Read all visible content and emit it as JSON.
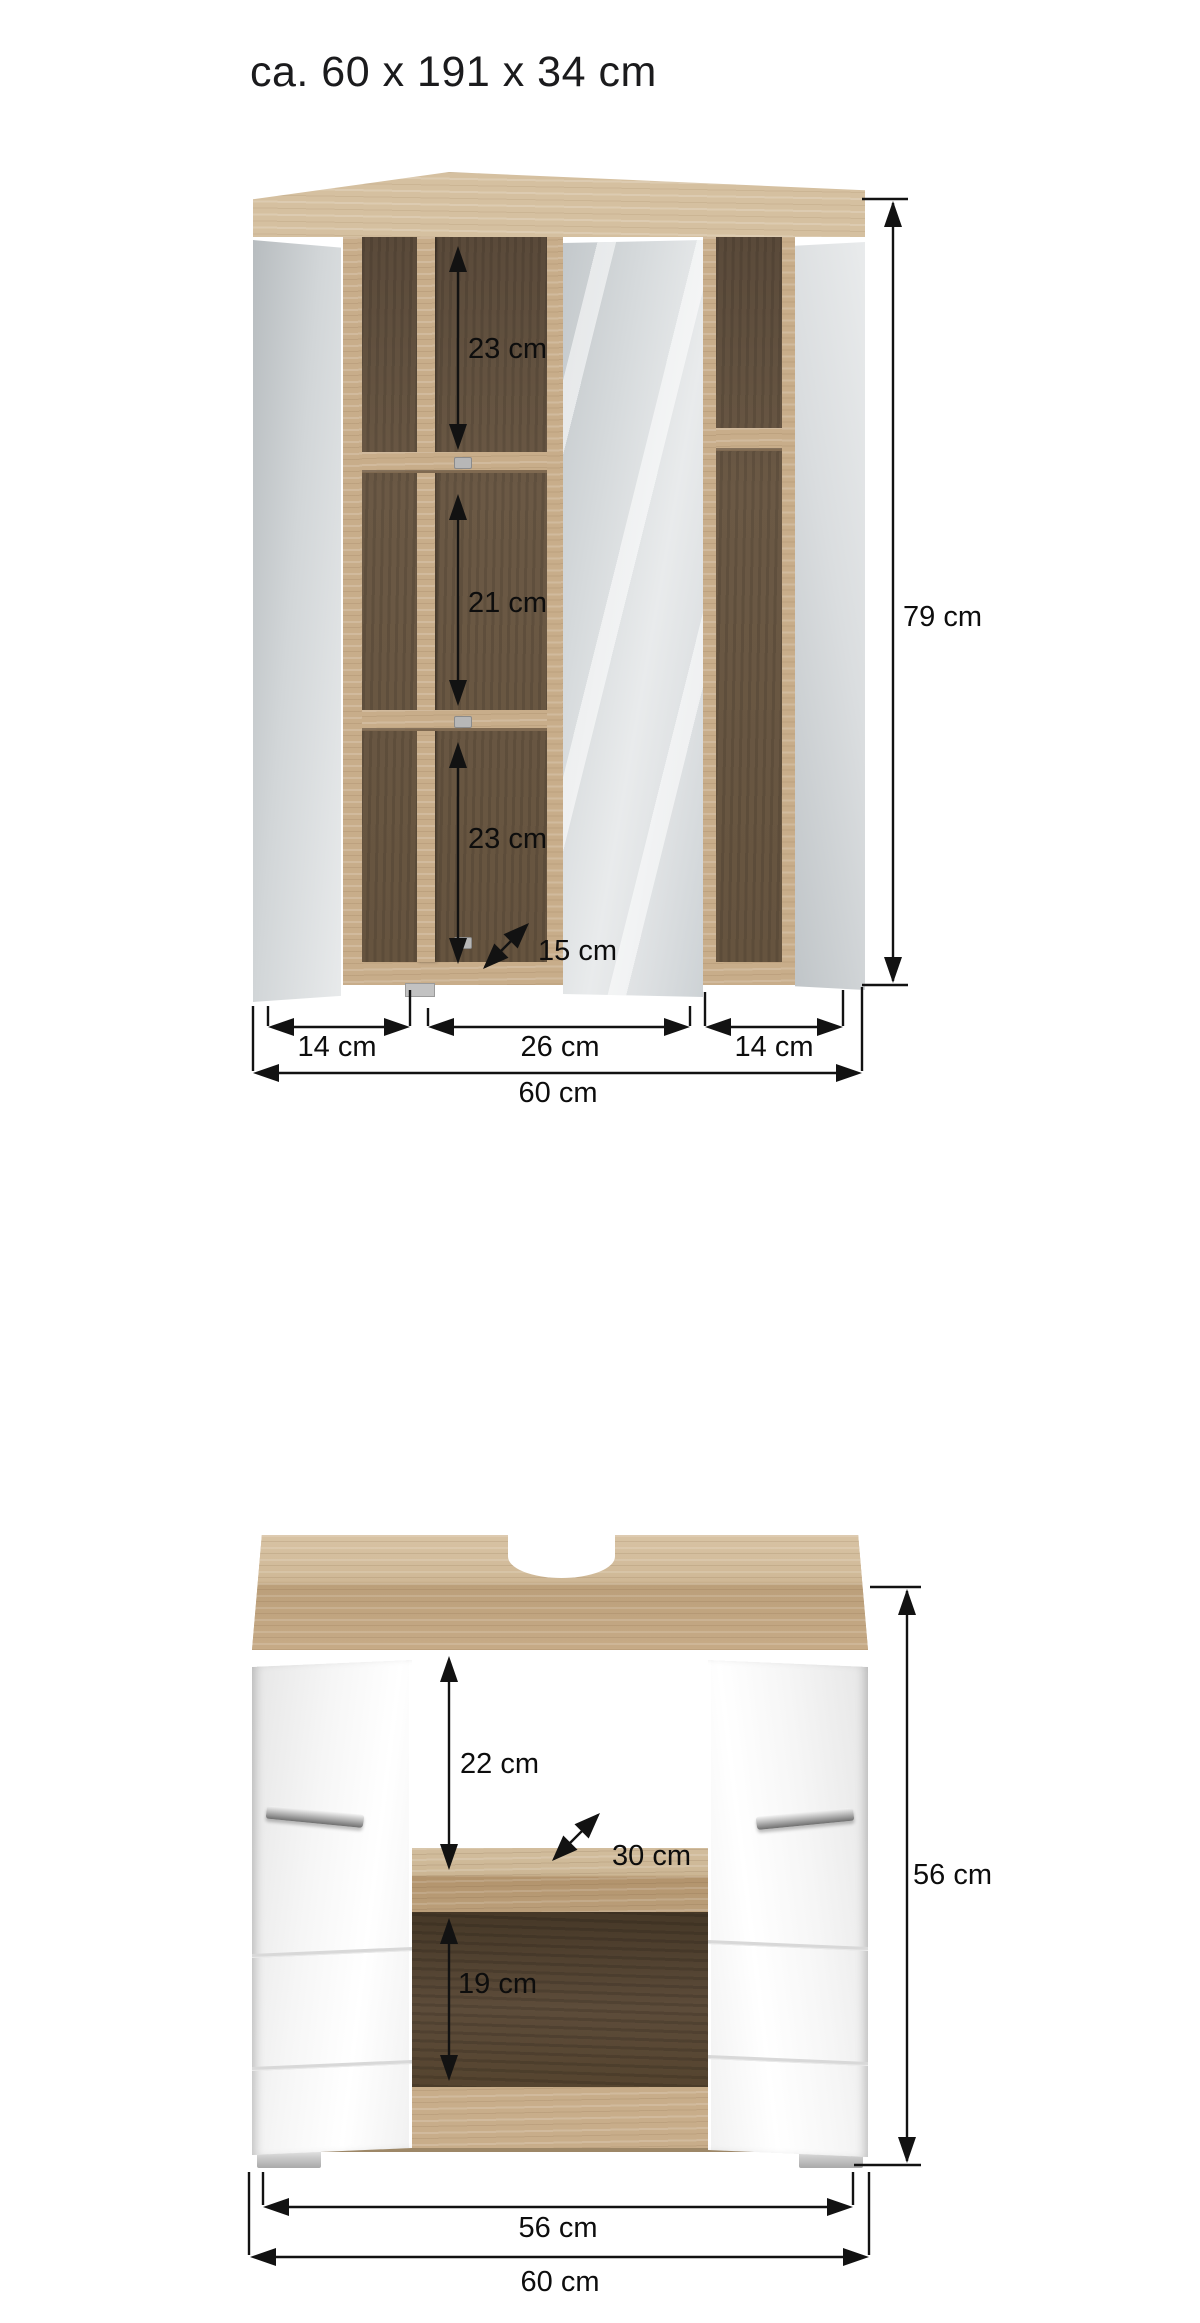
{
  "title": {
    "text": "ca. 60 x 191 x 34 cm"
  },
  "colors": {
    "background": "#ffffff",
    "oak_light": "#c8ad8a",
    "oak_top_face": "#d5c0a0",
    "interior_dark_oak": "#6b5945",
    "vanity_interior_dark": "#5d4c3a",
    "mirror_gray": "#d6dadc",
    "door_white": "#f6f6f6",
    "chrome_handle": "#b9b9b9",
    "foot_gray": "#cccccc",
    "dimension_ink": "#121212"
  },
  "mirror_cabinet": {
    "name": "mirror cabinet front view",
    "shelf_gaps": [
      {
        "label": "23 cm"
      },
      {
        "label": "21 cm"
      },
      {
        "label": "23 cm"
      }
    ],
    "depth_dim": {
      "label": "15 cm"
    },
    "height_dim": {
      "label": "79 cm"
    },
    "section_widths": [
      {
        "label": "14 cm"
      },
      {
        "label": "26 cm"
      },
      {
        "label": "14 cm"
      }
    ],
    "total_width": {
      "label": "60 cm"
    }
  },
  "vanity_cabinet": {
    "name": "washbasin vanity front view",
    "upper_gap": {
      "label": "22 cm"
    },
    "depth_dim": {
      "label": "30 cm"
    },
    "lower_gap": {
      "label": "19 cm"
    },
    "height_dim": {
      "label": "56 cm"
    },
    "inner_width": {
      "label": "56 cm"
    },
    "total_width": {
      "label": "60 cm"
    }
  }
}
